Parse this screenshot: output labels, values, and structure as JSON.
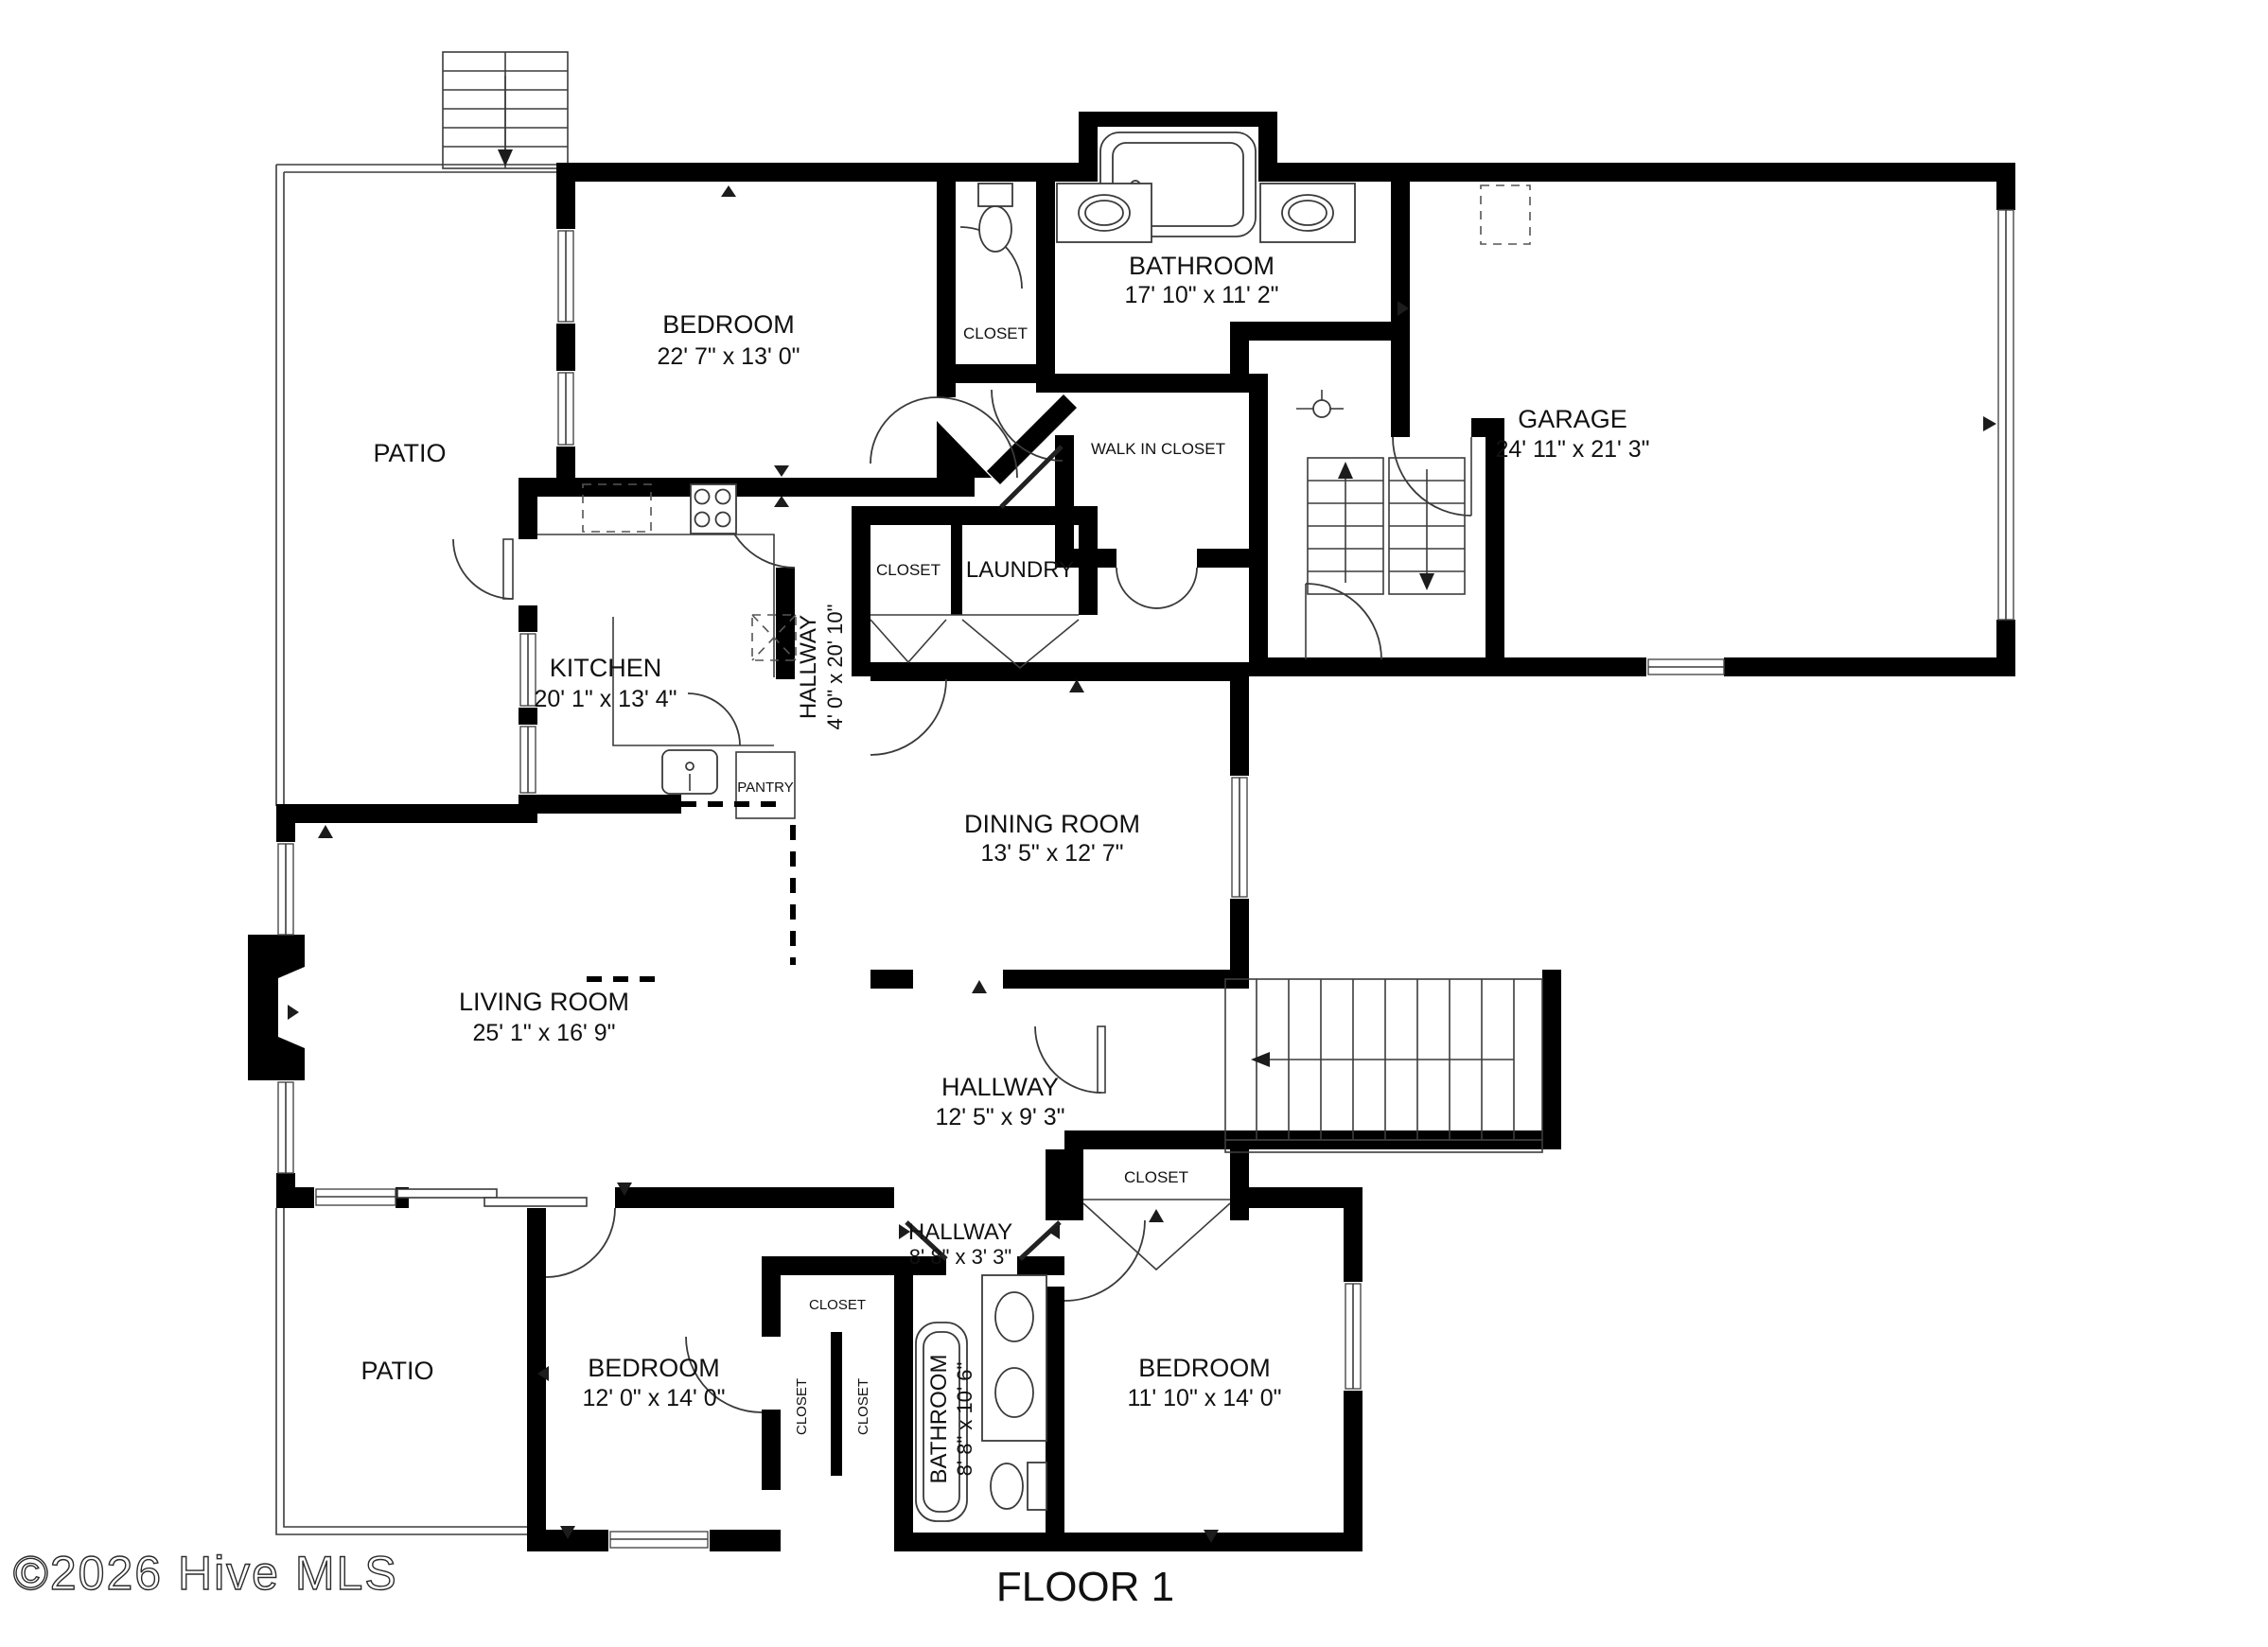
{
  "page": {
    "background": "#ffffff",
    "wall_color": "#000000",
    "text_color": "#111111"
  },
  "title": {
    "text": "FLOOR 1"
  },
  "watermark": {
    "text": "©2026 Hive MLS"
  },
  "rooms": {
    "patio_top": {
      "name": "PATIO"
    },
    "bedroom_top": {
      "name": "BEDROOM",
      "dims": "22' 7\" x 13' 0\""
    },
    "closet_top": {
      "name": "CLOSET"
    },
    "bathroom_top": {
      "name": "BATHROOM",
      "dims": "17' 10\" x 11' 2\""
    },
    "walk_in_closet": {
      "name": "WALK IN CLOSET"
    },
    "garage": {
      "name": "GARAGE",
      "dims": "24' 11\" x 21' 3\""
    },
    "closet_laundry": {
      "name": "CLOSET"
    },
    "laundry": {
      "name": "LAUNDRY"
    },
    "kitchen": {
      "name": "KITCHEN",
      "dims": "20' 1\" x 13' 4\""
    },
    "hallway_main": {
      "name": "HALLWAY",
      "dims": "4' 0\" x 20' 10\""
    },
    "pantry": {
      "name": "PANTRY"
    },
    "dining_room": {
      "name": "DINING ROOM",
      "dims": "13' 5\" x 12' 7\""
    },
    "living_room": {
      "name": "LIVING ROOM",
      "dims": "25' 1\" x 16' 9\""
    },
    "hallway_center": {
      "name": "HALLWAY",
      "dims": "12' 5\" x 9' 3\""
    },
    "closet_stairs": {
      "name": "CLOSET"
    },
    "hallway_south": {
      "name": "HALLWAY",
      "dims": "8' 8\" x 3' 3\""
    },
    "patio_bottom": {
      "name": "PATIO"
    },
    "bedroom_left": {
      "name": "BEDROOM",
      "dims": "12' 0\" x 14' 0\""
    },
    "closet_bl_top": {
      "name": "CLOSET"
    },
    "closet_bl_left": {
      "name": "CLOSET"
    },
    "closet_bl_right": {
      "name": "CLOSET"
    },
    "bathroom_bottom": {
      "name": "BATHROOM",
      "dims": "8' 8\" x 10' 6\""
    },
    "bedroom_right": {
      "name": "BEDROOM",
      "dims": "11' 10\" x 14' 0\""
    }
  }
}
